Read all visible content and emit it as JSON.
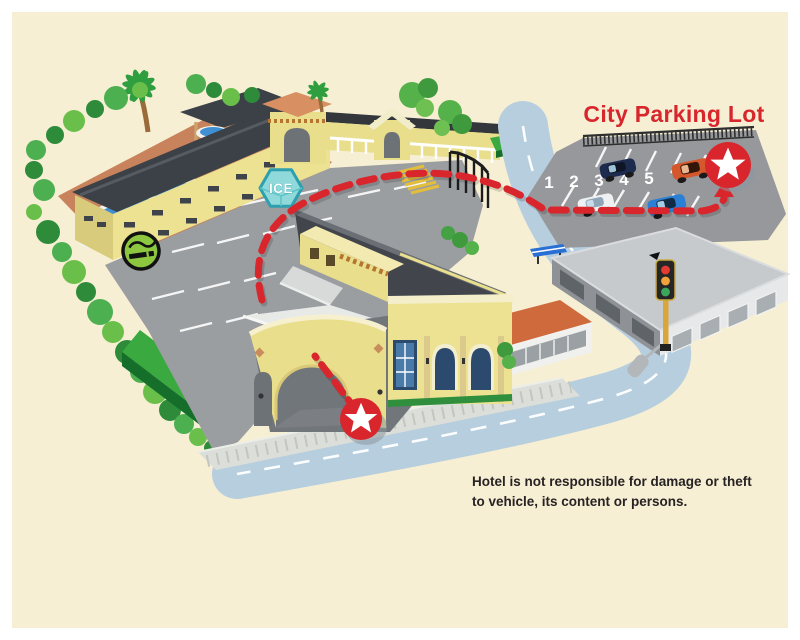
{
  "map": {
    "title": "City Parking Lot",
    "parking_spaces": [
      "1",
      "2",
      "3",
      "4",
      "5"
    ],
    "ice_label": "ICE",
    "disclaimer": {
      "line1": "Hotel is not responsible for damage or theft",
      "line2": "to vehicle, its content or persons."
    },
    "colors": {
      "background_cream": "#f7efd4",
      "title_red": "#d8262d",
      "route_red": "#d8262c",
      "road_blue": "#b6cedd",
      "lot_gray": "#9a9ea1",
      "building_yellow": "#ece292",
      "roof_dark": "#42464c",
      "hedge_green": "#3aa93f",
      "ice_teal": "#8fd9da",
      "smoking_green": "#8dc63f"
    }
  }
}
